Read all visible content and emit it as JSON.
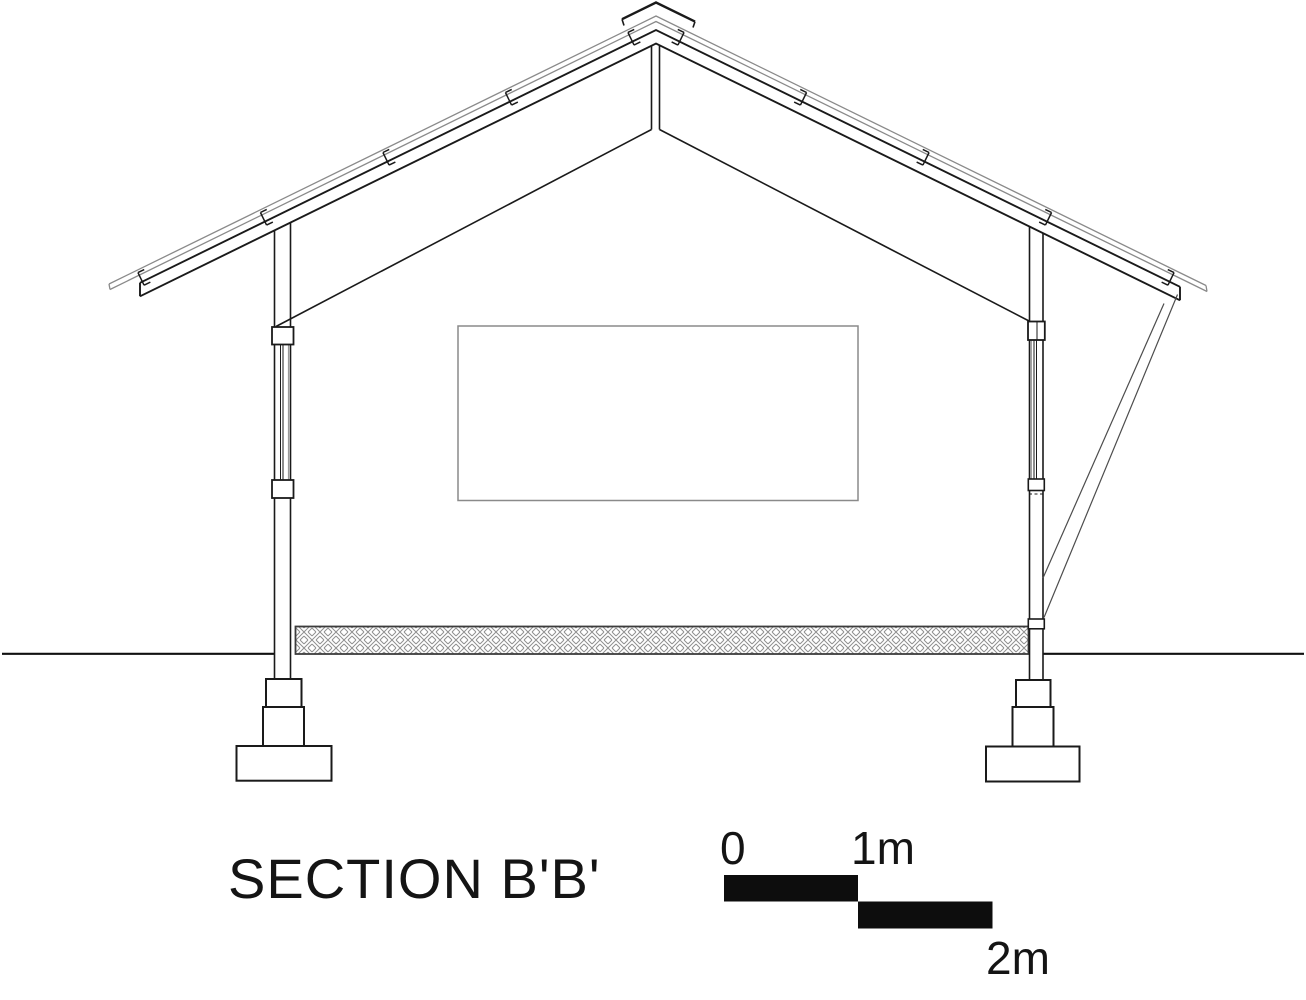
{
  "drawing": {
    "title": "SECTION B'B'",
    "type": "architectural-section-elevation"
  },
  "scale_bar": {
    "label_zero": "0",
    "label_one": "1m",
    "label_two": "2m",
    "units": "m",
    "segment_meters": 1,
    "total_meters": 2,
    "fill_color": "#0d0d0d"
  },
  "colors": {
    "background": "#ffffff",
    "line_black": "#1a1a1a",
    "roof_sheet_gray": "#8a8a8a",
    "window_border_gray": "#8a8a8a",
    "slab_hatch_gray": "#8f8f8f",
    "slab_edge": "#3c3c3c",
    "brace_gray": "#4d4d4d",
    "ground_line": "#111111"
  }
}
